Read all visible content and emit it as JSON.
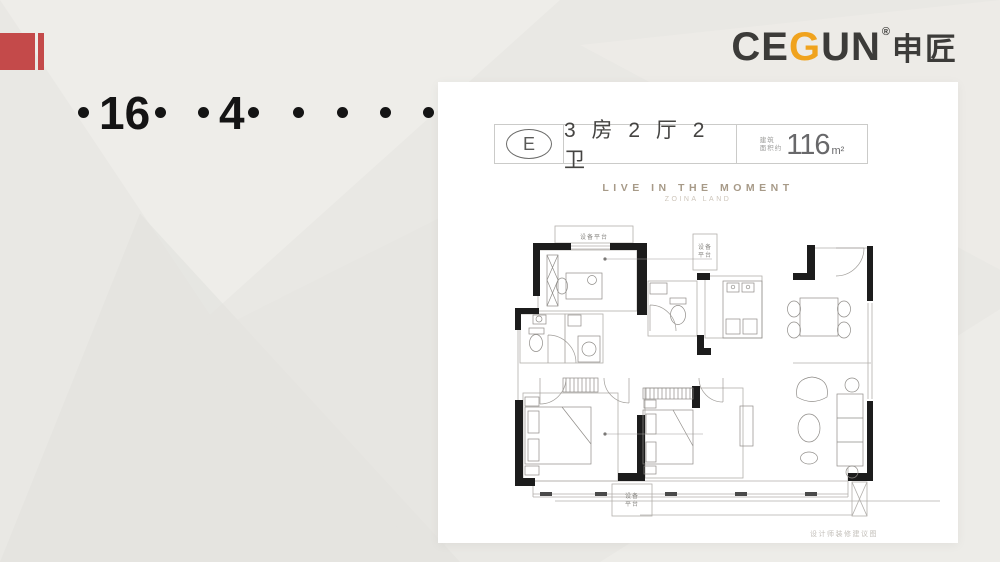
{
  "brand": {
    "logo_prefix": "CE",
    "logo_g": "G",
    "logo_suffix": "UN",
    "registered": "®",
    "logo_cn": "申匠",
    "g_color": "#F0A31E",
    "text_color": "#3C3B39"
  },
  "decor": {
    "red_block_color": "#C44A4A",
    "background_color": "#E9E8E4"
  },
  "dots_row": {
    "items": [
      {
        "type": "dot",
        "x": 78
      },
      {
        "type": "num",
        "text": "16",
        "x": 99
      },
      {
        "type": "dot",
        "x": 155
      },
      {
        "type": "dot",
        "x": 198
      },
      {
        "type": "num",
        "text": "4",
        "x": 219
      },
      {
        "type": "dot",
        "x": 248
      },
      {
        "type": "dot",
        "x": 293
      },
      {
        "type": "dot",
        "x": 337
      },
      {
        "type": "dot",
        "x": 380
      },
      {
        "type": "dot",
        "x": 423
      }
    ]
  },
  "card": {
    "unit_label": "E",
    "unit_rooms": "3 房 2 厅 2 卫",
    "area_prefix_line1": "建筑",
    "area_prefix_line2": "面积约",
    "area_value": "116",
    "area_unit": "m²",
    "tagline": "LIVE IN THE MOMENT",
    "tagline_sub": "ZOINA LAND",
    "plan": {
      "label_top": "设备平台",
      "label_right_1": "设备",
      "label_right_2": "平台",
      "label_bottom_1": "设备",
      "label_bottom_2": "平台",
      "note": "设计师装修建议图"
    }
  }
}
